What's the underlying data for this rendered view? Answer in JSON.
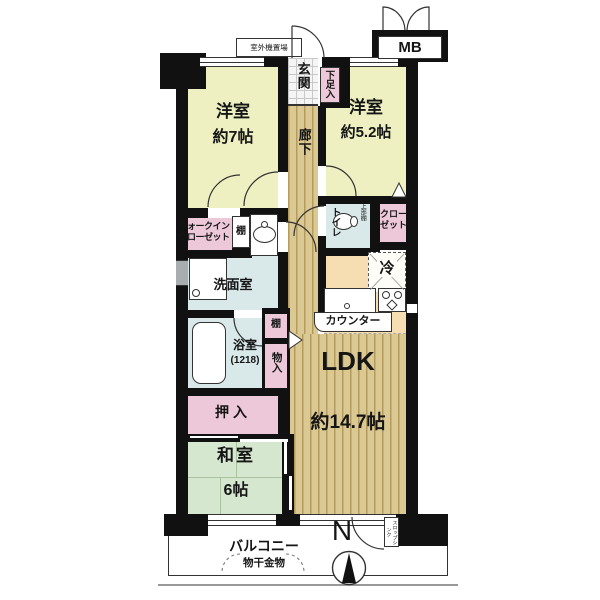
{
  "colors": {
    "wall": "#111111",
    "room_yellow": "#eef0c2",
    "closet_pink": "#ecc8d8",
    "water_blue": "#d9e9ea",
    "kitchen_peach": "#f6ddb2",
    "wood_light": "#dbc993",
    "wood_dark": "#b59a5e",
    "tatami_green": "#d6e7d0"
  },
  "labels": {
    "outdoor_unit": "室外機置場",
    "mb": "MB",
    "genkan": "玄関",
    "shoe_box": "下足入",
    "room7_name": "洋室",
    "room7_size": "約7帖",
    "room52_name": "洋室",
    "room52_size": "約5.2帖",
    "corridor": "廊下",
    "toilet": "トイレ",
    "toilet_shelf": "上部棚",
    "closet_l1": "クロー",
    "closet_l2": "ゼット",
    "fridge": "冷",
    "counter": "カウンター",
    "wic_l1": "ウォークイン",
    "wic_l2": "クローゼット",
    "shelf_wic": "棚",
    "washroom": "洗面室",
    "bath_name": "浴室",
    "bath_size": "(1218)",
    "shelf_bath": "棚",
    "storage": "物入",
    "oshiire": "押入",
    "washitsu_name": "和室",
    "washitsu_size": "6帖",
    "ldk_name": "LDK",
    "ldk_size": "約14.7帖",
    "balcony": "バルコニー",
    "laundry_hook": "物干金物",
    "slop_sink": "スロップシンク",
    "compass_north": "N"
  }
}
